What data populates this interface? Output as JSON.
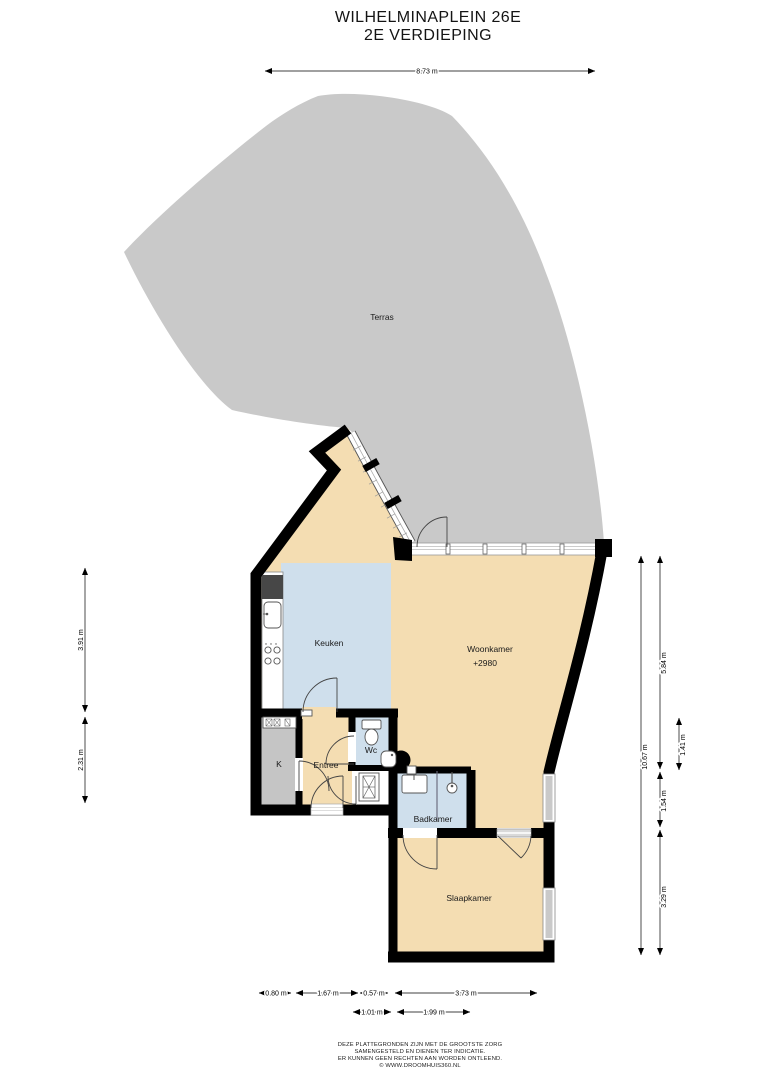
{
  "title": {
    "line1": "WILHELMINAPLEIN 26E",
    "line2": "2E VERDIEPING"
  },
  "rooms": {
    "terras": "Terras",
    "keuken": "Keuken",
    "woonkamer": "Woonkamer",
    "woonkamer_level": "+2980",
    "entree": "Entree",
    "wc": "Wc",
    "kast": "K",
    "badkamer": "Badkamer",
    "slaapkamer": "Slaapkamer"
  },
  "dimensions": {
    "top": "8.73 m",
    "left_upper": "3.91 m",
    "left_lower": "2.31 m",
    "right_total": "10.67 m",
    "right_upper": "5.84 m",
    "right_inner": "1.41 m",
    "right_middle": "1.54 m",
    "right_lower": "3.29 m",
    "bottom_row1": [
      "0.80 m",
      "1.67 m",
      "0.57 m",
      "3.73 m"
    ],
    "bottom_row2": [
      "1.01 m",
      "1.99 m"
    ]
  },
  "footer": {
    "line1": "DEZE PLATTEGRONDEN ZIJN MET DE GROOTSTE ZORG",
    "line2": "SAMENGESTELD EN DIENEN TER INDICATIE.",
    "line3": "ER KUNNEN GEEN RECHTEN AAN WORDEN ONTLEEND.",
    "line4": "© WWW.DROOMHUIS360.NL"
  },
  "colors": {
    "terrace": "#c9c9c9",
    "floor": "#f4ddb2",
    "wet_room": "#cfdfec",
    "closet": "#c5c5c5",
    "wall": "#000000"
  }
}
